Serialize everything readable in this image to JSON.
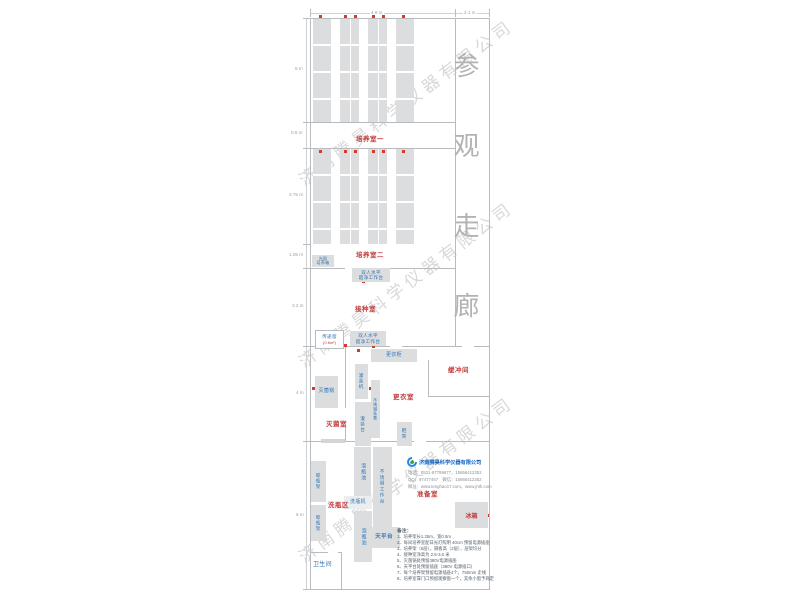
{
  "watermark": {
    "text": "济南腾昊科学仪器有限公司"
  },
  "dimensions": {
    "top_main": "4.8 m",
    "top_corridor": "2.1 m",
    "left": [
      "5 m",
      "0.6 m",
      "3.75 m",
      "1.05 m",
      "3.2 m",
      "4 m",
      "6 m"
    ]
  },
  "corridor": {
    "label": "参观走廊"
  },
  "rooms": {
    "culture1": "培养室一",
    "culture2": "培养室二",
    "inoculation": "接种室",
    "sterilization": "灭菌室",
    "changing": "更衣室",
    "buffer": "缓冲间",
    "washing": "洗瓶区",
    "prep": "准备室",
    "toilet": "卫生间"
  },
  "equipment": {
    "light_incubator": "光照\n培养箱",
    "clean_bench": "双人水平\n超净工作台",
    "pass_window": "传递窗",
    "pass_window_size": "(0.6m²)",
    "autoclave": "灭菌锅",
    "filling_machine": "灌装机",
    "steel_bench": "不锈钢条凳",
    "filling_table": "灌装台",
    "wardrobe": "更衣柜",
    "shoe_rack": "鞋架",
    "soak_pool": "泡瓶池",
    "bottle_washer": "洗瓶机",
    "steel_worktable": "不锈钢工作台",
    "balance_table": "天平台",
    "drying_rack": "晾瓶架",
    "fridge": "冰箱"
  },
  "company": {
    "name": "济南腾昊科学仪器有限公司",
    "phone": "电话：0531-87799677，15866412352",
    "qq": "QQ：97477467　微信：15866412352",
    "web": "网址：www.tenghao17.com，www.jnth.com"
  },
  "notes": {
    "title": "备注：",
    "items": [
      "1、培养架长1.25m，宽0.5m",
      "2、每间培养室配日光灯照明 40cm 预留电源插座",
      "3、培养架（5层），隔板高（2层），层架均分",
      "4、接种室净高为 2.6-3.0 米",
      "5、灭菌锅处预留380V电源插座",
      "6、天平台处预留插座（380V 电源插口）",
      "7、每个培养架预留电源插座4个，750mm 走线",
      "8、培养室靠门口预留观察窗一个，其余小窗予商定"
    ]
  }
}
